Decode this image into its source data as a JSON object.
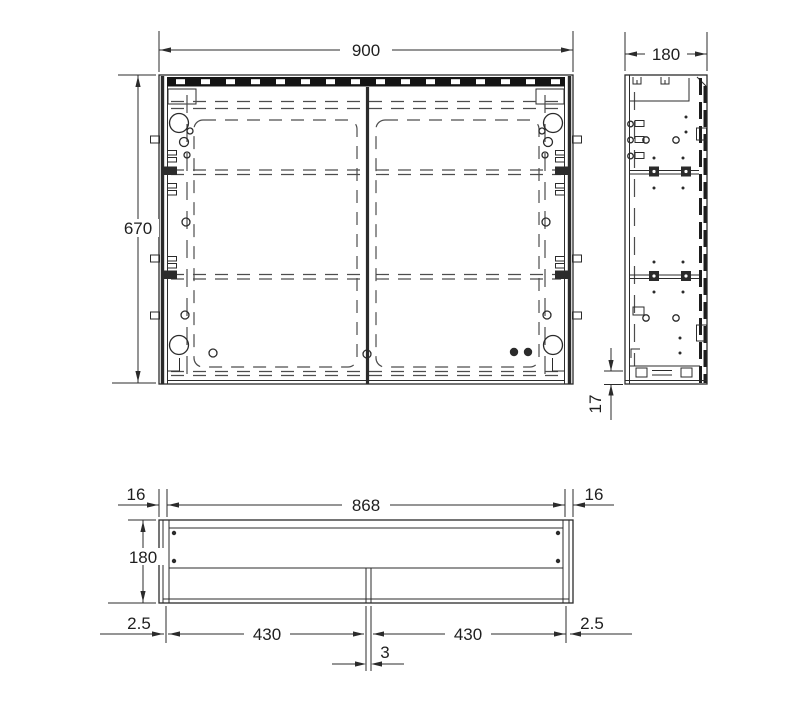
{
  "dimensions": {
    "front_view": {
      "width": "900",
      "height": "670"
    },
    "side_view": {
      "depth": "180",
      "bottom_panel": "17"
    },
    "top_view": {
      "inner_width": "868",
      "left_side_panel": "16",
      "right_side_panel": "16",
      "depth": "180",
      "left_reveal": "2.5",
      "right_reveal": "2.5",
      "left_door_width": "430",
      "right_door_width": "430",
      "center_gap": "3"
    }
  },
  "colors": {
    "line": "#2b2b2b",
    "hidden_line": "#4d4d4d",
    "rail": "#141414",
    "background": "#ffffff"
  }
}
